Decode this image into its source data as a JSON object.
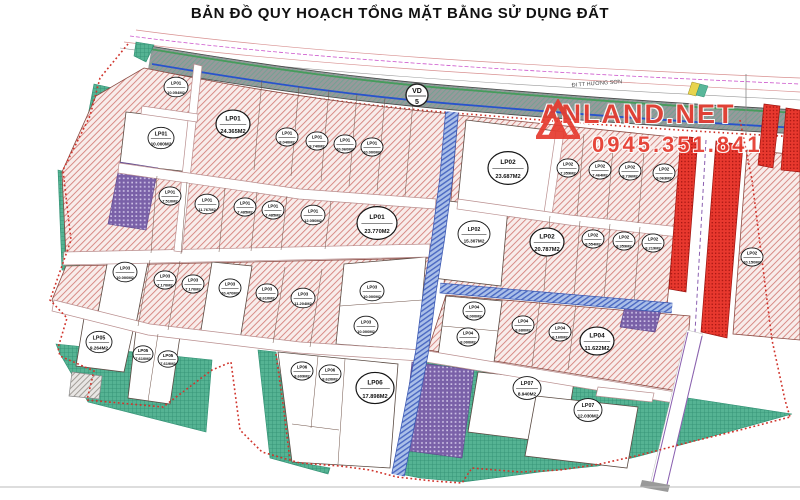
{
  "title": "BẢN ĐỒ QUY HOẠCH TỔNG MẶT BẰNG SỬ DỤNG ĐẤT",
  "map": {
    "direction_label_ne": "ĐI TT HƯƠNG SƠN",
    "road_marker": {
      "line1": "VD",
      "line2": "5"
    },
    "watermark": {
      "brand": "ANLAND.NET",
      "phone": "0945.351.841"
    }
  },
  "colors": {
    "pink_zone": "#f8ecea",
    "hatch_red": "#d4827d",
    "teal_zone": "#55b393",
    "purple_zone": "#7a61a8",
    "blue_road": "#aabfe8",
    "red_zone": "#e8382e",
    "road_gray": "#97999b",
    "boundary_red": "#d0342c",
    "watermark_red": "#e63c30"
  },
  "plots": [
    {
      "code": "LP01",
      "area": "10.054M2",
      "x": 176,
      "y": 87,
      "r": 12
    },
    {
      "code": "LP01",
      "area": "10.000M2",
      "x": 161,
      "y": 138,
      "r": 13
    },
    {
      "code": "LP01",
      "area": "24.365M2",
      "x": 233,
      "y": 124,
      "r": 17
    },
    {
      "code": "LP01",
      "area": "8.040M2",
      "x": 287,
      "y": 137,
      "r": 11
    },
    {
      "code": "LP01",
      "area": "9.740M2",
      "x": 317,
      "y": 141,
      "r": 11
    },
    {
      "code": "LP01",
      "area": "10.060M2",
      "x": 345,
      "y": 144,
      "r": 11
    },
    {
      "code": "LP01",
      "area": "10.000M2",
      "x": 372,
      "y": 147,
      "r": 11
    },
    {
      "code": "LP01",
      "area": "7.510M2",
      "x": 170,
      "y": 196,
      "r": 11
    },
    {
      "code": "LP01",
      "area": "11.767M2",
      "x": 207,
      "y": 204,
      "r": 12
    },
    {
      "code": "LP01",
      "area": "7.485M2",
      "x": 245,
      "y": 207,
      "r": 11
    },
    {
      "code": "LP01",
      "area": "7.485M2",
      "x": 273,
      "y": 210,
      "r": 11
    },
    {
      "code": "LP01",
      "area": "12.050M2",
      "x": 313,
      "y": 215,
      "r": 12
    },
    {
      "code": "LP01",
      "area": "23.770M2",
      "x": 377,
      "y": 223,
      "r": 20
    },
    {
      "code": "LP02",
      "area": "23.687M2",
      "x": 508,
      "y": 168,
      "r": 20
    },
    {
      "code": "LP02",
      "area": "7.359M2",
      "x": 568,
      "y": 168,
      "r": 11
    },
    {
      "code": "LP02",
      "area": "7.464M2",
      "x": 600,
      "y": 170,
      "r": 11
    },
    {
      "code": "LP02",
      "area": "8.736M2",
      "x": 630,
      "y": 171,
      "r": 11
    },
    {
      "code": "LP02",
      "area": "9.063M2",
      "x": 664,
      "y": 173,
      "r": 11
    },
    {
      "code": "LP02",
      "area": "15.307M2",
      "x": 474,
      "y": 234,
      "r": 16
    },
    {
      "code": "LP02",
      "area": "20.787M2",
      "x": 547,
      "y": 242,
      "r": 17
    },
    {
      "code": "LP02",
      "area": "8.554M2",
      "x": 593,
      "y": 239,
      "r": 11
    },
    {
      "code": "LP02",
      "area": "8.359M2",
      "x": 624,
      "y": 241,
      "r": 11
    },
    {
      "code": "LP02",
      "area": "8.219M2",
      "x": 653,
      "y": 243,
      "r": 11
    },
    {
      "code": "LP02",
      "area": "10.150M2",
      "x": 752,
      "y": 257,
      "r": 11
    },
    {
      "code": "LP03",
      "area": "10.000M2",
      "x": 125,
      "y": 272,
      "r": 12
    },
    {
      "code": "LP03",
      "area": "7.170M2",
      "x": 165,
      "y": 280,
      "r": 11
    },
    {
      "code": "LP03",
      "area": "7.170M2",
      "x": 193,
      "y": 284,
      "r": 11
    },
    {
      "code": "LP03",
      "area": "10.470M2",
      "x": 230,
      "y": 288,
      "r": 11
    },
    {
      "code": "LP03",
      "area": "8.610M2",
      "x": 267,
      "y": 293,
      "r": 11
    },
    {
      "code": "LP03",
      "area": "11.204M2",
      "x": 303,
      "y": 298,
      "r": 12
    },
    {
      "code": "LP03",
      "area": "10.000M2",
      "x": 372,
      "y": 291,
      "r": 12
    },
    {
      "code": "LP03",
      "area": "10.000M2",
      "x": 366,
      "y": 326,
      "r": 12
    },
    {
      "code": "LP04",
      "area": "8.000M2",
      "x": 474,
      "y": 311,
      "r": 11
    },
    {
      "code": "LP04",
      "area": "8.000M2",
      "x": 468,
      "y": 337,
      "r": 11
    },
    {
      "code": "LP04",
      "area": "8.680M2",
      "x": 523,
      "y": 325,
      "r": 11
    },
    {
      "code": "LP04",
      "area": "6.160M2",
      "x": 560,
      "y": 332,
      "r": 11
    },
    {
      "code": "LP04",
      "area": "11.622M2",
      "x": 597,
      "y": 341,
      "r": 17
    },
    {
      "code": "LP05",
      "area": "9.264M2",
      "x": 99,
      "y": 342,
      "r": 13
    },
    {
      "code": "LP05",
      "area": "7.610M2",
      "x": 143,
      "y": 354,
      "r": 10
    },
    {
      "code": "LP05",
      "area": "7.619M2",
      "x": 168,
      "y": 359,
      "r": 10
    },
    {
      "code": "LP06",
      "area": "8.609M2",
      "x": 302,
      "y": 371,
      "r": 11
    },
    {
      "code": "LP06",
      "area": "8.620M2",
      "x": 330,
      "y": 374,
      "r": 11
    },
    {
      "code": "LP06",
      "area": "17.898M2",
      "x": 375,
      "y": 388,
      "r": 19
    },
    {
      "code": "LP07",
      "area": "8.940M2",
      "x": 527,
      "y": 388,
      "r": 14
    },
    {
      "code": "LP07",
      "area": "12.030M2",
      "x": 588,
      "y": 410,
      "r": 14
    }
  ]
}
